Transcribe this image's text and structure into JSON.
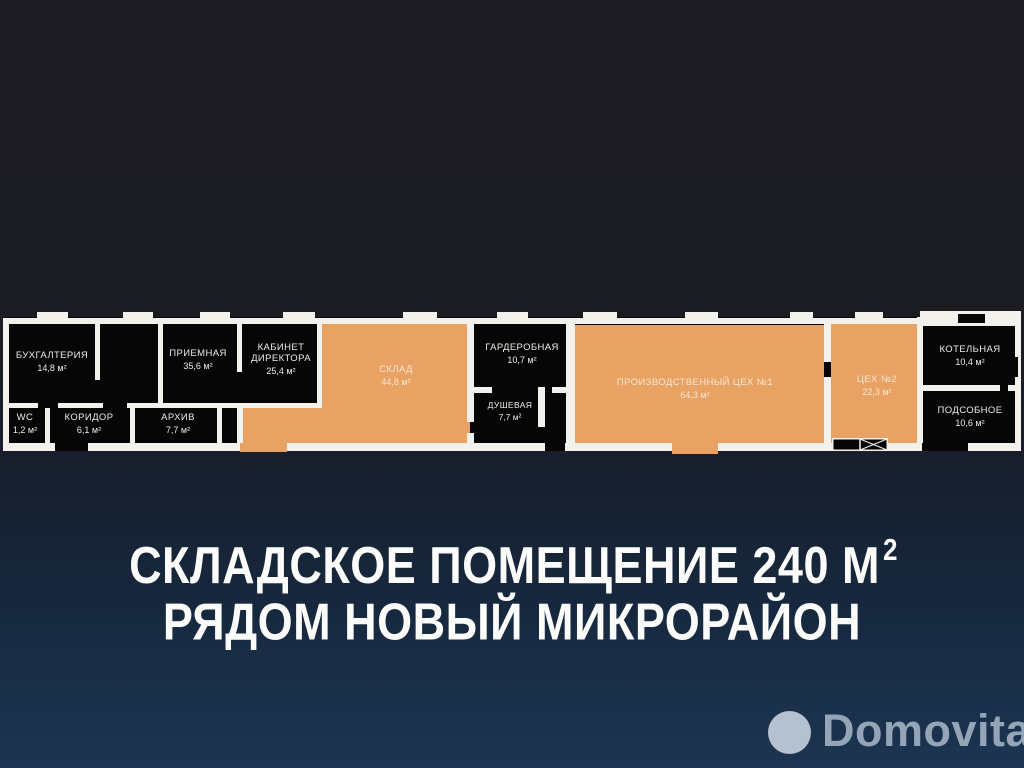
{
  "listing": {
    "title_line1": "СКЛАДСКОЕ ПОМЕЩЕНИЕ 240 М",
    "title_line1_sup": "2",
    "title_line2": "РЯДОМ НОВЫЙ МИКРОРАЙОН"
  },
  "watermark": {
    "brand": "Domovita"
  },
  "colors": {
    "room_fill_orange": "#e8a263",
    "wall_white": "#f3f1ec",
    "room_fill_dark": "#060606",
    "background_top": "#1b1b21",
    "background_bottom": "#1c3552",
    "title_text": "#fbfbfa",
    "watermark_text": "#94a5b8",
    "watermark_circle": "#b5c1ce"
  },
  "floorplan": {
    "rooms": [
      {
        "name": "БУХГАЛТЕРИЯ",
        "area": "14,8 м²",
        "fill": "dark"
      },
      {
        "name": "ПРИЕМНАЯ",
        "area": "35,6 м²",
        "fill": "dark"
      },
      {
        "name": "КАБИНЕТ ДИРЕКТОРА",
        "area": "25,4 м²",
        "fill": "dark"
      },
      {
        "name": "WC",
        "area": "1,2 м²",
        "fill": "dark"
      },
      {
        "name": "КОРИДОР",
        "area": "6,1 м²",
        "fill": "dark"
      },
      {
        "name": "АРХИВ",
        "area": "7,7 м²",
        "fill": "dark"
      },
      {
        "name": "СКЛАД",
        "area": "44,8 м²",
        "fill": "orange"
      },
      {
        "name": "ГАРДЕРОБНАЯ",
        "area": "10,7 м²",
        "fill": "dark"
      },
      {
        "name": "ДУШЕВАЯ",
        "area": "7,7 м²",
        "fill": "dark"
      },
      {
        "name": "ПРОИЗВОДСТВЕННЫЙ  ЦЕХ №1",
        "area": "64,3 м²",
        "fill": "orange"
      },
      {
        "name": "ЦЕХ №2",
        "area": "22,3 м²",
        "fill": "orange"
      },
      {
        "name": "КОТЕЛЬНАЯ",
        "area": "10,4 м²",
        "fill": "dark"
      },
      {
        "name": "ПОДСОБНОЕ",
        "area": "10,6 м²",
        "fill": "dark"
      }
    ]
  }
}
